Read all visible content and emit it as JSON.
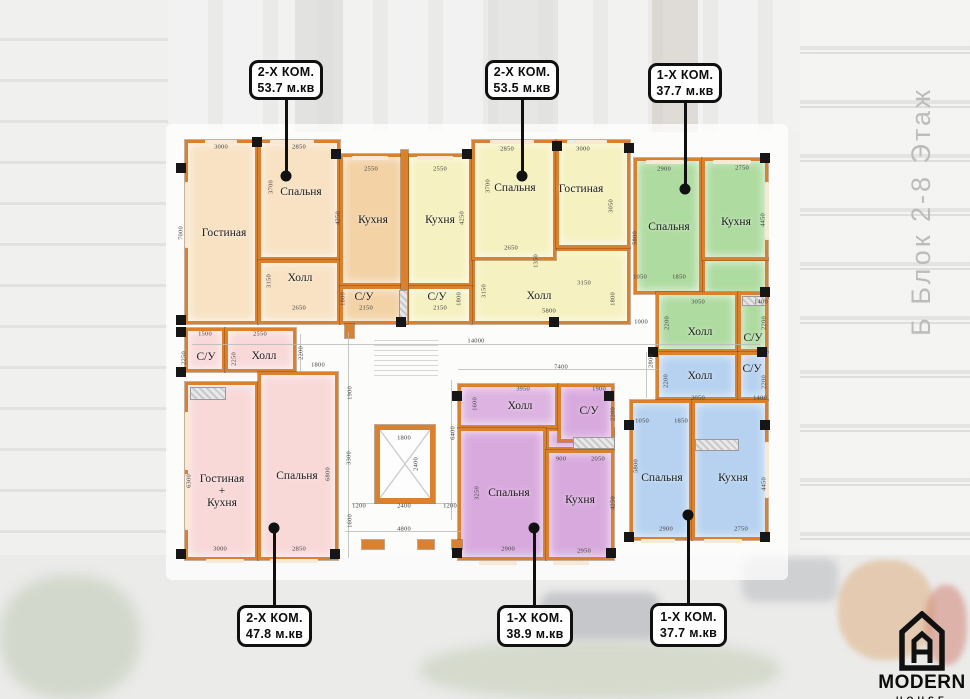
{
  "side_label": "Б Блок 2-8 Этаж",
  "logo": {
    "name": "MODERN",
    "sub": "HOUSE"
  },
  "callouts": {
    "top": [
      {
        "type": "2-Х КОМ.",
        "area": "53.7 м.кв",
        "box": [
          249,
          60,
          74,
          40
        ],
        "dot": [
          286,
          176
        ]
      },
      {
        "type": "2-Х КОМ.",
        "area": "53.5 м.кв",
        "box": [
          485,
          60,
          74,
          40
        ],
        "dot": [
          522,
          176
        ]
      },
      {
        "type": "1-Х КОМ.",
        "area": "37.7 м.кв",
        "box": [
          648,
          63,
          74,
          40
        ],
        "dot": [
          685,
          189
        ]
      }
    ],
    "bottom": [
      {
        "type": "2-Х КОМ.",
        "area": "47.8 м.кв",
        "box": [
          237,
          605,
          75,
          42
        ],
        "dot": [
          274,
          528
        ]
      },
      {
        "type": "1-Х КОМ.",
        "area": "38.9 м.кв",
        "box": [
          497,
          605,
          76,
          42
        ],
        "dot": [
          534,
          528
        ]
      },
      {
        "type": "1-Х КОМ.",
        "area": "37.7 м.кв",
        "box": [
          650,
          603,
          77,
          44
        ],
        "dot": [
          688,
          515
        ]
      }
    ]
  },
  "apartments": [
    {
      "id": "apt-2k-53-7",
      "color": "#f8e2c3",
      "rooms": [
        {
          "label": "Гостиная",
          "rect": [
            185,
            140,
            73,
            184
          ],
          "lc": [
            224,
            233
          ]
        },
        {
          "label": "Спальня",
          "rect": [
            258,
            140,
            82,
            120
          ],
          "lc": [
            301,
            192
          ]
        },
        {
          "label": "Холл",
          "rect": [
            258,
            260,
            82,
            64
          ],
          "lc": [
            300,
            278
          ]
        },
        {
          "label": "Кухня",
          "rect": [
            340,
            154,
            66,
            132
          ],
          "lc": [
            373,
            220
          ],
          "color": "#f3d2a6"
        },
        {
          "label": "С/У",
          "rect": [
            340,
            286,
            66,
            38
          ],
          "lc": [
            364,
            297
          ],
          "color": "#f3d2a6"
        }
      ]
    },
    {
      "id": "apt-2k-53-5",
      "color": "#f6f1c0",
      "rooms": [
        {
          "label": "Холл",
          "rect": [
            472,
            248,
            158,
            76
          ],
          "lc": [
            539,
            296
          ]
        },
        {
          "label": "Кухня",
          "rect": [
            406,
            154,
            66,
            132
          ],
          "lc": [
            440,
            220
          ]
        },
        {
          "label": "С/У",
          "rect": [
            406,
            286,
            66,
            38
          ],
          "lc": [
            437,
            297
          ]
        },
        {
          "label": "Спальня",
          "rect": [
            472,
            140,
            84,
            120
          ],
          "lc": [
            515,
            188
          ]
        },
        {
          "label": "Гостиная",
          "rect": [
            556,
            140,
            74,
            108
          ],
          "lc": [
            581,
            189
          ]
        }
      ]
    },
    {
      "id": "apt-1k-37-7-up",
      "color": "#aedba0",
      "rooms": [
        {
          "label": "",
          "rect": [
            702,
            258,
            66,
            40
          ],
          "lc": [
            0,
            0
          ]
        },
        {
          "label": "Спальня",
          "rect": [
            634,
            158,
            68,
            136
          ],
          "lc": [
            669,
            227
          ]
        },
        {
          "label": "Кухня",
          "rect": [
            702,
            158,
            66,
            102
          ],
          "lc": [
            736,
            222
          ]
        },
        {
          "label": "Холл",
          "rect": [
            656,
            292,
            82,
            60
          ],
          "lc": [
            700,
            332
          ]
        },
        {
          "label": "С/У",
          "rect": [
            738,
            292,
            30,
            60
          ],
          "lc": [
            753,
            338
          ]
        }
      ]
    },
    {
      "id": "apt-2k-47-8",
      "color": "#f9d8d8",
      "rooms": [
        {
          "label": "С/У",
          "rect": [
            185,
            328,
            40,
            44
          ],
          "lc": [
            206,
            357
          ]
        },
        {
          "label": "Холл",
          "rect": [
            225,
            328,
            71,
            44
          ],
          "lc": [
            264,
            356
          ]
        },
        {
          "label": "Гостиная\n+\nКухня",
          "rect": [
            185,
            382,
            73,
            178
          ],
          "lc": [
            222,
            491
          ]
        },
        {
          "label": "Спальня",
          "rect": [
            258,
            372,
            80,
            188
          ],
          "lc": [
            297,
            476
          ]
        }
      ]
    },
    {
      "id": "apt-1k-38-9",
      "color": "#d8a9dd",
      "rooms": [
        {
          "label": "",
          "rect": [
            546,
            428,
            68,
            22
          ],
          "lc": [
            0,
            0
          ]
        },
        {
          "label": "Холл",
          "rect": [
            458,
            384,
            100,
            44
          ],
          "lc": [
            520,
            406
          ],
          "color": "#ddb4e1"
        },
        {
          "label": "С/У",
          "rect": [
            558,
            384,
            56,
            58
          ],
          "lc": [
            589,
            411
          ]
        },
        {
          "label": "Спальня",
          "rect": [
            458,
            428,
            88,
            132
          ],
          "lc": [
            509,
            493
          ]
        },
        {
          "label": "Кухня",
          "rect": [
            546,
            450,
            68,
            110
          ],
          "lc": [
            580,
            500
          ]
        }
      ]
    },
    {
      "id": "apt-1k-37-7-low",
      "color": "#b6d2f0",
      "rooms": [
        {
          "label": "Холл",
          "rect": [
            656,
            352,
            82,
            48
          ],
          "lc": [
            700,
            376
          ]
        },
        {
          "label": "С/У",
          "rect": [
            738,
            352,
            30,
            48
          ],
          "lc": [
            752,
            369
          ]
        },
        {
          "label": "Спальня",
          "rect": [
            630,
            400,
            62,
            140
          ],
          "lc": [
            662,
            478
          ]
        },
        {
          "label": "Кухня",
          "rect": [
            692,
            400,
            76,
            140
          ],
          "lc": [
            733,
            478
          ]
        }
      ]
    }
  ],
  "dimensions": [
    {
      "t": "3000",
      "x": 221,
      "y": 147
    },
    {
      "t": "2850",
      "x": 299,
      "y": 147
    },
    {
      "t": "7000",
      "x": 181,
      "y": 233,
      "v": 1
    },
    {
      "t": "3700",
      "x": 271,
      "y": 187,
      "v": 1
    },
    {
      "t": "2550",
      "x": 371,
      "y": 169
    },
    {
      "t": "2550",
      "x": 440,
      "y": 169
    },
    {
      "t": "4250",
      "x": 338,
      "y": 218,
      "v": 1
    },
    {
      "t": "4250",
      "x": 462,
      "y": 218,
      "v": 1
    },
    {
      "t": "3150",
      "x": 269,
      "y": 281,
      "v": 1
    },
    {
      "t": "2650",
      "x": 299,
      "y": 308
    },
    {
      "t": "2150",
      "x": 366,
      "y": 308
    },
    {
      "t": "1800",
      "x": 343,
      "y": 299,
      "v": 1
    },
    {
      "t": "2150",
      "x": 440,
      "y": 308
    },
    {
      "t": "1800",
      "x": 459,
      "y": 299,
      "v": 1
    },
    {
      "t": "2850",
      "x": 507,
      "y": 149
    },
    {
      "t": "3000",
      "x": 583,
      "y": 149
    },
    {
      "t": "3700",
      "x": 488,
      "y": 186,
      "v": 1
    },
    {
      "t": "3050",
      "x": 611,
      "y": 206,
      "v": 1
    },
    {
      "t": "2650",
      "x": 511,
      "y": 248
    },
    {
      "t": "1350",
      "x": 536,
      "y": 261,
      "v": 1
    },
    {
      "t": "3150",
      "x": 584,
      "y": 283
    },
    {
      "t": "3150",
      "x": 484,
      "y": 291,
      "v": 1
    },
    {
      "t": "1800",
      "x": 613,
      "y": 299,
      "v": 1
    },
    {
      "t": "5800",
      "x": 549,
      "y": 311
    },
    {
      "t": "2900",
      "x": 664,
      "y": 169
    },
    {
      "t": "2750",
      "x": 742,
      "y": 168
    },
    {
      "t": "5800",
      "x": 635,
      "y": 238,
      "v": 1
    },
    {
      "t": "4450",
      "x": 763,
      "y": 220,
      "v": 1
    },
    {
      "t": "1050",
      "x": 640,
      "y": 277
    },
    {
      "t": "1850",
      "x": 679,
      "y": 277
    },
    {
      "t": "3050",
      "x": 698,
      "y": 302
    },
    {
      "t": "1400",
      "x": 761,
      "y": 302
    },
    {
      "t": "2200",
      "x": 667,
      "y": 323,
      "v": 1
    },
    {
      "t": "2200",
      "x": 764,
      "y": 323,
      "v": 1
    },
    {
      "t": "1000",
      "x": 641,
      "y": 322
    },
    {
      "t": "14000",
      "x": 476,
      "y": 341
    },
    {
      "t": "1500",
      "x": 205,
      "y": 334
    },
    {
      "t": "2550",
      "x": 260,
      "y": 334
    },
    {
      "t": "2200",
      "x": 301,
      "y": 353,
      "v": 1
    },
    {
      "t": "1800",
      "x": 318,
      "y": 365
    },
    {
      "t": "1900",
      "x": 350,
      "y": 393,
      "v": 1
    },
    {
      "t": "3300",
      "x": 349,
      "y": 458,
      "v": 1
    },
    {
      "t": "1600",
      "x": 350,
      "y": 521,
      "v": 1
    },
    {
      "t": "6400",
      "x": 453,
      "y": 433,
      "v": 1
    },
    {
      "t": "2800",
      "x": 651,
      "y": 361,
      "v": 1
    },
    {
      "t": "7400",
      "x": 561,
      "y": 367
    },
    {
      "t": "1800",
      "x": 404,
      "y": 438
    },
    {
      "t": "2400",
      "x": 416,
      "y": 464,
      "v": 1
    },
    {
      "t": "1200",
      "x": 359,
      "y": 506
    },
    {
      "t": "2400",
      "x": 404,
      "y": 506
    },
    {
      "t": "1200",
      "x": 450,
      "y": 506
    },
    {
      "t": "4800",
      "x": 404,
      "y": 529
    },
    {
      "t": "2250",
      "x": 184,
      "y": 358,
      "v": 1
    },
    {
      "t": "2250",
      "x": 234,
      "y": 359,
      "v": 1
    },
    {
      "t": "6300",
      "x": 189,
      "y": 481,
      "v": 1
    },
    {
      "t": "6800",
      "x": 328,
      "y": 474,
      "v": 1
    },
    {
      "t": "3000",
      "x": 220,
      "y": 549
    },
    {
      "t": "2850",
      "x": 299,
      "y": 549
    },
    {
      "t": "3950",
      "x": 523,
      "y": 389
    },
    {
      "t": "1900",
      "x": 599,
      "y": 389
    },
    {
      "t": "1600",
      "x": 475,
      "y": 404,
      "v": 1
    },
    {
      "t": "2200",
      "x": 613,
      "y": 414,
      "v": 1
    },
    {
      "t": "900",
      "x": 561,
      "y": 459
    },
    {
      "t": "2050",
      "x": 598,
      "y": 459
    },
    {
      "t": "3250",
      "x": 477,
      "y": 493,
      "v": 1
    },
    {
      "t": "4250",
      "x": 613,
      "y": 503,
      "v": 1
    },
    {
      "t": "2900",
      "x": 508,
      "y": 549
    },
    {
      "t": "2950",
      "x": 584,
      "y": 551
    },
    {
      "t": "3050",
      "x": 698,
      "y": 398
    },
    {
      "t": "1400",
      "x": 760,
      "y": 398
    },
    {
      "t": "2200",
      "x": 666,
      "y": 381,
      "v": 1
    },
    {
      "t": "2200",
      "x": 764,
      "y": 382,
      "v": 1
    },
    {
      "t": "1050",
      "x": 642,
      "y": 421
    },
    {
      "t": "1850",
      "x": 681,
      "y": 421
    },
    {
      "t": "5800",
      "x": 636,
      "y": 466,
      "v": 1
    },
    {
      "t": "4450",
      "x": 764,
      "y": 484,
      "v": 1
    },
    {
      "t": "2900",
      "x": 666,
      "y": 529
    },
    {
      "t": "2750",
      "x": 741,
      "y": 529
    }
  ]
}
